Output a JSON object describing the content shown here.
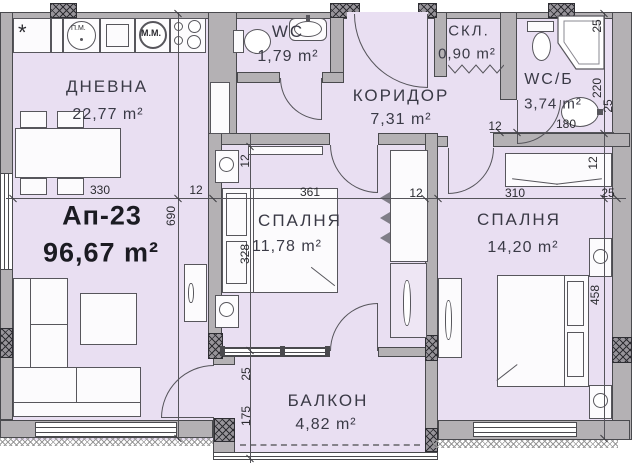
{
  "plan": {
    "apartment_label": "Ап-23",
    "apartment_area": "96,67 m²"
  },
  "rooms": {
    "livingroom": {
      "name": "ДНЕВНА",
      "area": "22,77 m²"
    },
    "wc": {
      "name": "WC",
      "area": "1,79 m²"
    },
    "corridor": {
      "name": "КОРИДОР",
      "area": "7,31 m²"
    },
    "storage": {
      "name": "СКЛ.",
      "area": "0,90 m²"
    },
    "bathroom": {
      "name": "WC/Б",
      "area": "3,74 m²"
    },
    "bedroom1": {
      "name": "СПАЛНЯ",
      "area": "11,78 m²"
    },
    "bedroom2": {
      "name": "СПАЛНЯ",
      "area": "14,20 m²"
    },
    "balcony": {
      "name": "БАЛКОН",
      "area": "4,82 m²"
    }
  },
  "appliances": {
    "washing_machine": "П.М.",
    "dishwasher": "М.М.",
    "sink_mark": "*"
  },
  "dims": {
    "h": [
      "330",
      "12",
      "361",
      "12",
      "310",
      "25"
    ],
    "left_v": "690",
    "mid_v": [
      "12",
      "328",
      "25",
      "175"
    ],
    "right_v": [
      "25",
      "220",
      "25",
      "12",
      "458"
    ],
    "bath": [
      "12",
      "180"
    ]
  },
  "colors": {
    "floor": "#e9dff2",
    "wall": "#b4b1b4",
    "line": "#3c3c40"
  }
}
